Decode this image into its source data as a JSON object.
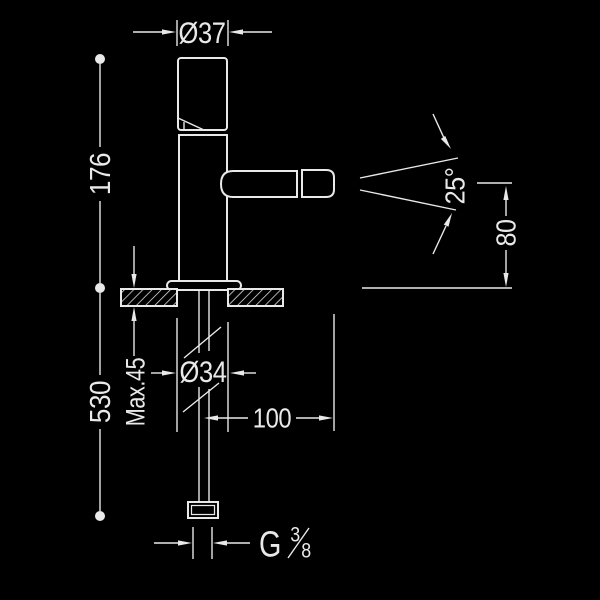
{
  "drawing": {
    "type": "faucet-installation-dimension-drawing",
    "labels": {
      "top_diameter": "Ø37",
      "body_height": "176",
      "hose_length": "530",
      "max_deck_thickness": "Max.45",
      "hole_diameter": "Ø34",
      "spout_reach": "100",
      "swivel_angle": "25°",
      "spout_height": "80",
      "thread": {
        "prefix": "G",
        "numerator": "3",
        "denominator": "8"
      }
    }
  },
  "colors": {
    "background": "#000000",
    "line": "#e9e9e9"
  }
}
